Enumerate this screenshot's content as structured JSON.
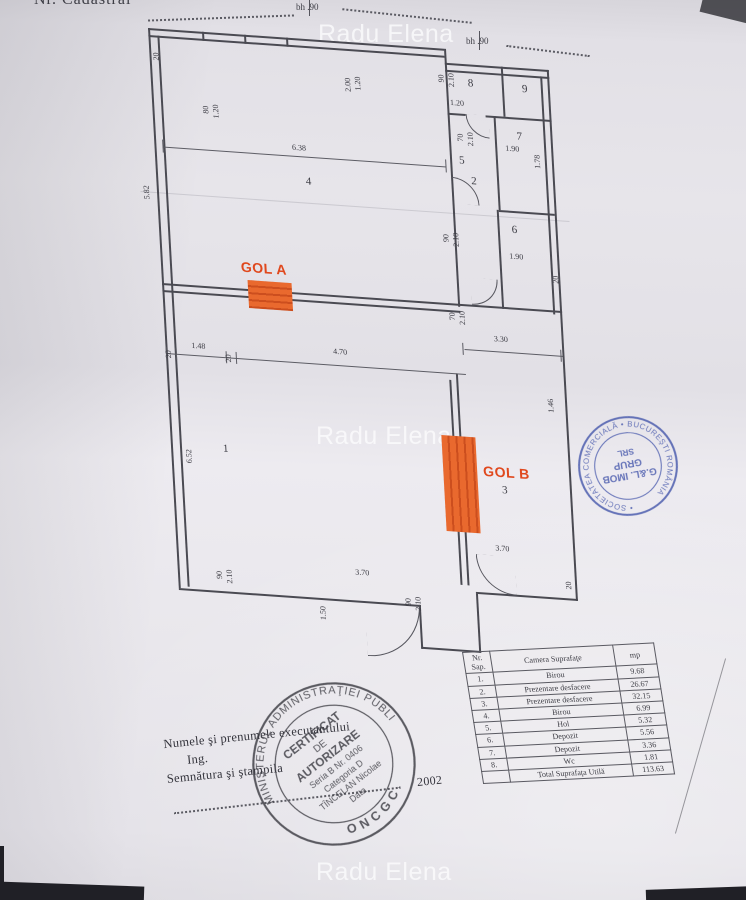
{
  "watermark": {
    "text": "Radu Elena"
  },
  "header": {
    "cadastral_label": "Nr. Cadastral",
    "bh_marks": [
      "bh .90",
      "bh .90"
    ]
  },
  "plan": {
    "highlight_color": "#e8642c",
    "labels": [
      {
        "t": "20",
        "x": 3,
        "y": 24,
        "r": 1
      },
      {
        "t": "80",
        "x": 50,
        "y": 74,
        "r": 1
      },
      {
        "t": "1.20",
        "x": 60,
        "y": 72,
        "r": 1
      },
      {
        "t": "2.00",
        "x": 194,
        "y": 36,
        "r": 1
      },
      {
        "t": "1.20",
        "x": 204,
        "y": 34,
        "r": 1
      },
      {
        "t": "6.38",
        "x": 138,
        "y": 106
      },
      {
        "t": "4",
        "x": 150,
        "y": 138,
        "c": "room"
      },
      {
        "t": "5.82",
        "x": -14,
        "y": 158,
        "r": 1
      },
      {
        "t": "90",
        "x": 288,
        "y": 26,
        "r": 1
      },
      {
        "t": "2.10",
        "x": 298,
        "y": 24,
        "r": 1
      },
      {
        "t": "1.20",
        "x": 299,
        "y": 50
      },
      {
        "t": "70",
        "x": 304,
        "y": 84,
        "r": 1
      },
      {
        "t": "2.10",
        "x": 314,
        "y": 82,
        "r": 1
      },
      {
        "t": "5",
        "x": 305,
        "y": 106,
        "c": "room"
      },
      {
        "t": "8",
        "x": 318,
        "y": 28,
        "c": "room"
      },
      {
        "t": "9",
        "x": 372,
        "y": 30,
        "c": "room"
      },
      {
        "t": "2",
        "x": 316,
        "y": 126,
        "c": "room"
      },
      {
        "t": "7",
        "x": 364,
        "y": 78,
        "c": "room"
      },
      {
        "t": "1.78",
        "x": 380,
        "y": 100,
        "r": 1
      },
      {
        "t": "1.90",
        "x": 352,
        "y": 92
      },
      {
        "t": "6",
        "x": 354,
        "y": 172,
        "c": "room"
      },
      {
        "t": "1.90",
        "x": 350,
        "y": 200
      },
      {
        "t": "90",
        "x": 284,
        "y": 186,
        "r": 1
      },
      {
        "t": "2.10",
        "x": 294,
        "y": 184,
        "r": 1
      },
      {
        "t": "70",
        "x": 286,
        "y": 264,
        "r": 1
      },
      {
        "t": "2.10",
        "x": 296,
        "y": 262,
        "r": 1
      },
      {
        "t": "20",
        "x": 392,
        "y": 220,
        "r": 1
      },
      {
        "t": "GOL A",
        "x": 80,
        "y": 226,
        "c": "gol"
      },
      {
        "t": "20",
        "x": -1,
        "y": 322,
        "r": 1
      },
      {
        "t": "1.48",
        "x": 26,
        "y": 312
      },
      {
        "t": "20",
        "x": 59,
        "y": 322,
        "r": 1
      },
      {
        "t": "4.70",
        "x": 168,
        "y": 308
      },
      {
        "t": "3.30",
        "x": 330,
        "y": 284
      },
      {
        "t": "GOL B",
        "x": 312,
        "y": 414,
        "c": "gol"
      },
      {
        "t": "3",
        "x": 330,
        "y": 434,
        "c": "room"
      },
      {
        "t": "1.46",
        "x": 380,
        "y": 344,
        "r": 1
      },
      {
        "t": "6.52",
        "x": 14,
        "y": 420,
        "r": 1
      },
      {
        "t": "1",
        "x": 52,
        "y": 412,
        "c": "room"
      },
      {
        "t": "90",
        "x": 38,
        "y": 540,
        "r": 1
      },
      {
        "t": "2.10",
        "x": 48,
        "y": 538,
        "r": 1
      },
      {
        "t": "3.70",
        "x": 178,
        "y": 528
      },
      {
        "t": "1.50",
        "x": 140,
        "y": 568,
        "r": 1
      },
      {
        "t": "90",
        "x": 226,
        "y": 554,
        "r": 1
      },
      {
        "t": "2.10",
        "x": 236,
        "y": 552,
        "r": 1
      },
      {
        "t": "3.70",
        "x": 320,
        "y": 494
      },
      {
        "t": "20",
        "x": 388,
        "y": 526,
        "r": 1
      }
    ]
  },
  "form": {
    "line1": "Numele şi prenumele executantului",
    "line2": "Ing.",
    "line3": "Semnătura şi ştampila",
    "year": "2002"
  },
  "stamps": {
    "round_black": {
      "ring_top": "MINISTERUL ADMINISTRAŢIEI PUBLICE",
      "ring_bottom": "ONCGC",
      "lines": [
        "CERTIFICAT",
        "DE",
        "AUTORIZARE",
        "Seria B Nr. 0406",
        "Categoria D",
        "TÎNCELAN Nicolae",
        "Data"
      ]
    },
    "round_blue": {
      "ring": "• SOCIETATEA COMERCIALĂ • BUCUREŞTI ROMÂNIA",
      "lines": [
        "G.&L. IMOB",
        "GRUP",
        "SRL"
      ]
    }
  },
  "table": {
    "col_nr_line1": "Nr.",
    "col_nr_line2": "Sap.",
    "col_name": "Camera Suprafaţe",
    "col_mp": "mp",
    "rows": [
      {
        "nr": "1.",
        "name": "Birou",
        "mp": "9.68"
      },
      {
        "nr": "2.",
        "name": "Prezentare desfacere",
        "mp": "26.67"
      },
      {
        "nr": "3.",
        "name": "Prezentare desfacere",
        "mp": "32.15"
      },
      {
        "nr": "4.",
        "name": "Birou",
        "mp": "6.99"
      },
      {
        "nr": "5.",
        "name": "Hol",
        "mp": "5.32"
      },
      {
        "nr": "6.",
        "name": "Depozit",
        "mp": "5.56"
      },
      {
        "nr": "7.",
        "name": "Depozit",
        "mp": "3.36"
      },
      {
        "nr": "8.",
        "name": "Wc",
        "mp": "1.81"
      }
    ],
    "total_label": "Total Suprafaţa Utilă",
    "total_value": "113.63"
  }
}
